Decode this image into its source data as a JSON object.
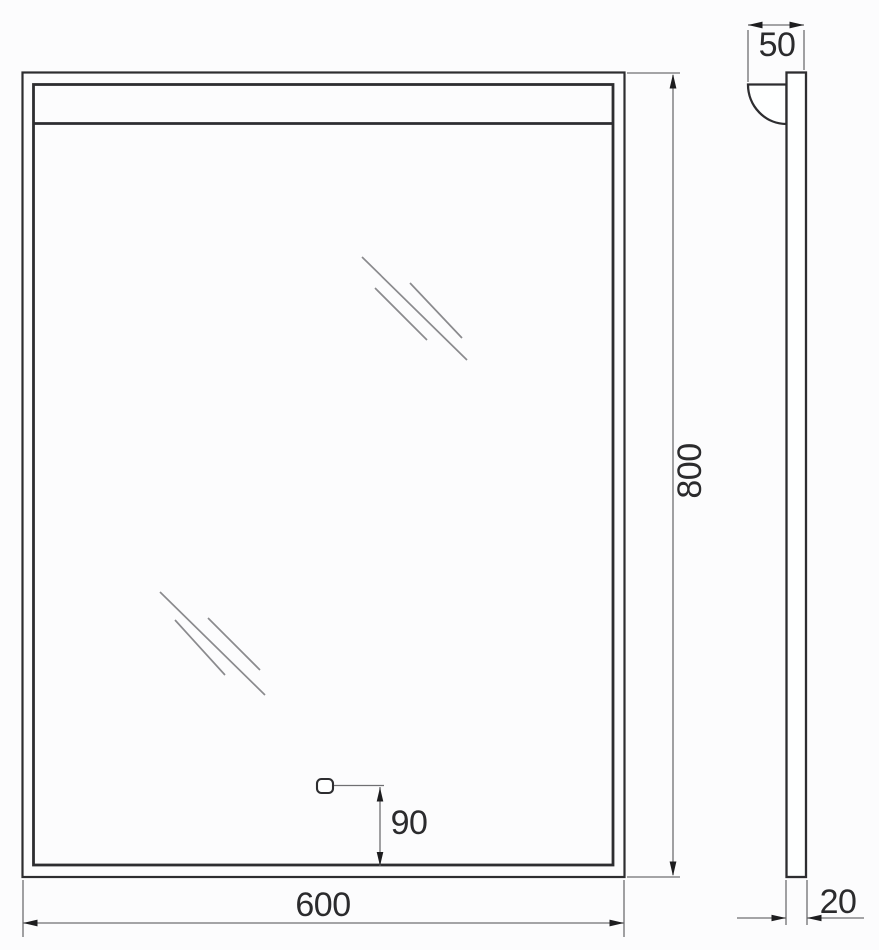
{
  "colors": {
    "background": "#fcfcfd",
    "frame_line": "#2d2d30",
    "dimension_line": "#6f6f72",
    "arrowhead": "#1d1d1f",
    "shine_line": "#8a8a8d",
    "label_text": "#2b2b2d"
  },
  "dimensions": {
    "front_width": {
      "label": "600"
    },
    "front_height": {
      "label": "800"
    },
    "sensor_offset": {
      "label": "90"
    },
    "side_depth": {
      "label": "50"
    },
    "side_thickness": {
      "label": "20"
    }
  },
  "icons": {
    "touch_sensor": "touch-sensor-button",
    "shine_marks": "mirror-shine-lines"
  }
}
